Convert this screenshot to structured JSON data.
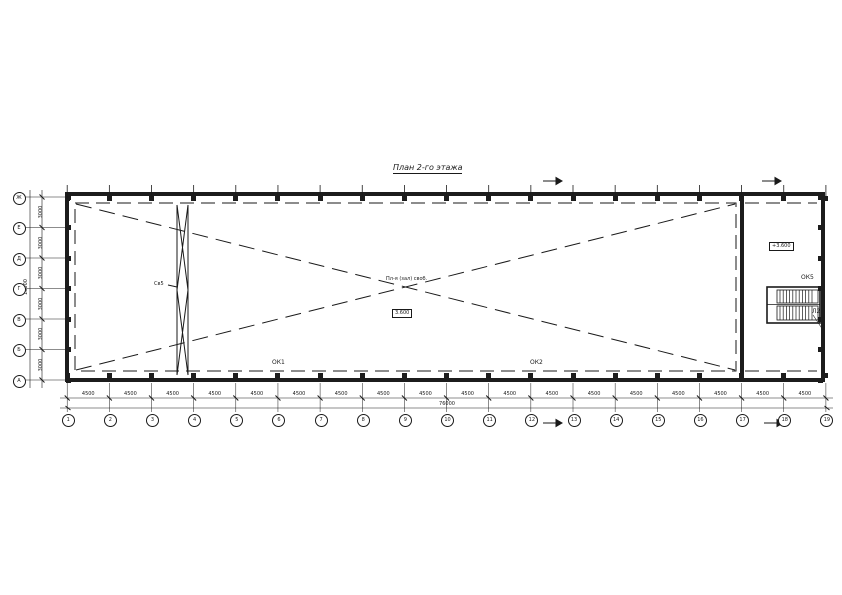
{
  "sheet": {
    "title": "План 2-го этажа"
  },
  "axes": {
    "bottom": [
      "1",
      "2",
      "3",
      "4",
      "5",
      "6",
      "7",
      "8",
      "9",
      "10",
      "11",
      "12",
      "13",
      "14",
      "15",
      "16",
      "17",
      "18",
      "19"
    ],
    "left": [
      "Ж",
      "Е",
      "Д",
      "Г",
      "В",
      "Б",
      "А"
    ]
  },
  "dims": {
    "bottom_bays": [
      "4500",
      "4500",
      "4500",
      "4500",
      "4500",
      "4500",
      "4500",
      "4500",
      "4500",
      "4500",
      "4500",
      "4500",
      "4500",
      "4500",
      "4500",
      "4500",
      "4500",
      "4500"
    ],
    "bottom_total": "76000",
    "left_bays": [
      "3000",
      "3000",
      "3000",
      "3000",
      "3000",
      "3000"
    ],
    "left_total": "18000"
  },
  "labels": {
    "ok1": "ОК1",
    "ok2": "ОК2",
    "ok5": "ОК5",
    "stair": "Л2",
    "elevation": "+3.600",
    "center_note": "Пл-я (зал) своб.",
    "center_value": "3.600",
    "brace": "Св5"
  },
  "colors": {
    "line": "#1a1a1a",
    "background": "#ffffff"
  }
}
